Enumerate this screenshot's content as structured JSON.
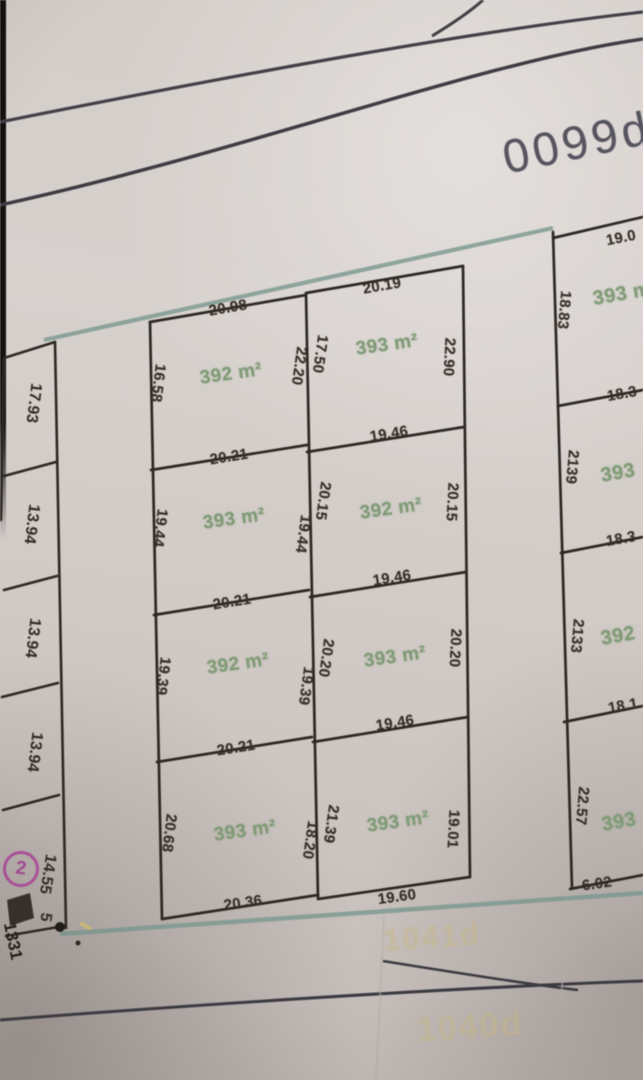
{
  "sheet_ref": "0099d",
  "colors": {
    "parcel_line": "#2b2520",
    "road_teal": "#76988f",
    "area_text_green": "#7e9c74",
    "marker_magenta": "#b14f9e",
    "watermark_yellow": "#c9ba8c"
  },
  "left_strip": {
    "parcels": [
      {
        "side": "17.93"
      },
      {
        "side": "13.94"
      },
      {
        "side": "13.94"
      },
      {
        "side": "13.94"
      },
      {
        "side": "14.55"
      }
    ],
    "extra_dim": "5",
    "marker": "2",
    "corner_text": "1331"
  },
  "col_left": {
    "parcels": [
      {
        "top": "20.98",
        "left": "16.58",
        "right": "22.20",
        "area": "392 m²"
      },
      {
        "top": "20.21",
        "left": "19.44",
        "right": "19.44",
        "area": "393 m²"
      },
      {
        "top": "20.21",
        "left": "19.39",
        "right": "19.39",
        "area": "392 m²"
      },
      {
        "top": "20.21",
        "left": "20.68",
        "right": "18.20",
        "area": "393 m²",
        "bottom": "20.36"
      }
    ]
  },
  "col_mid": {
    "parcels": [
      {
        "top": "20.19",
        "left": "17.50",
        "right": "22.90",
        "area": "393 m²",
        "bottom": "19.46"
      },
      {
        "left": "20.15",
        "right": "20.15",
        "area": "392 m²",
        "bottom": "19.46"
      },
      {
        "left": "20.20",
        "right": "20.20",
        "area": "393 m²",
        "bottom": "19.46"
      },
      {
        "left": "21.39",
        "right": "19.01",
        "area": "393 m²",
        "bottom": "19.60"
      }
    ]
  },
  "col_right": {
    "parcels": [
      {
        "top": "19.0",
        "left": "18.83",
        "area": "393 m"
      },
      {
        "top": "18.3",
        "left": "2139",
        "area": "393"
      },
      {
        "top": "18.3",
        "left": "2133",
        "area": "392"
      },
      {
        "top": "18.1",
        "left": "22.57",
        "area": "393",
        "bottom": "6.02"
      }
    ]
  },
  "watermarks": {
    "upper": "1041d",
    "lower": "1040d"
  }
}
